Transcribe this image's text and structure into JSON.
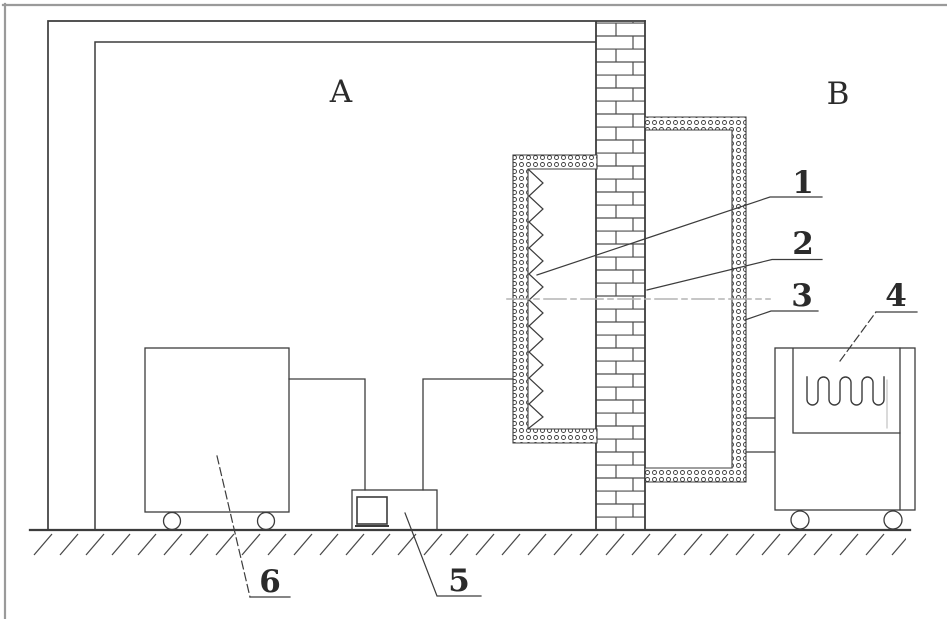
{
  "diagram": {
    "region_labels": {
      "a": "A",
      "b": "B"
    },
    "callouts": {
      "c1": "1",
      "c2": "2",
      "c3": "3",
      "c4": "4",
      "c5": "5",
      "c6": "6"
    },
    "colors": {
      "line": "#3c3c3c",
      "frame_outer": "#9a9a9a",
      "centerline": "#b4b4b4",
      "background": "#ffffff"
    }
  }
}
